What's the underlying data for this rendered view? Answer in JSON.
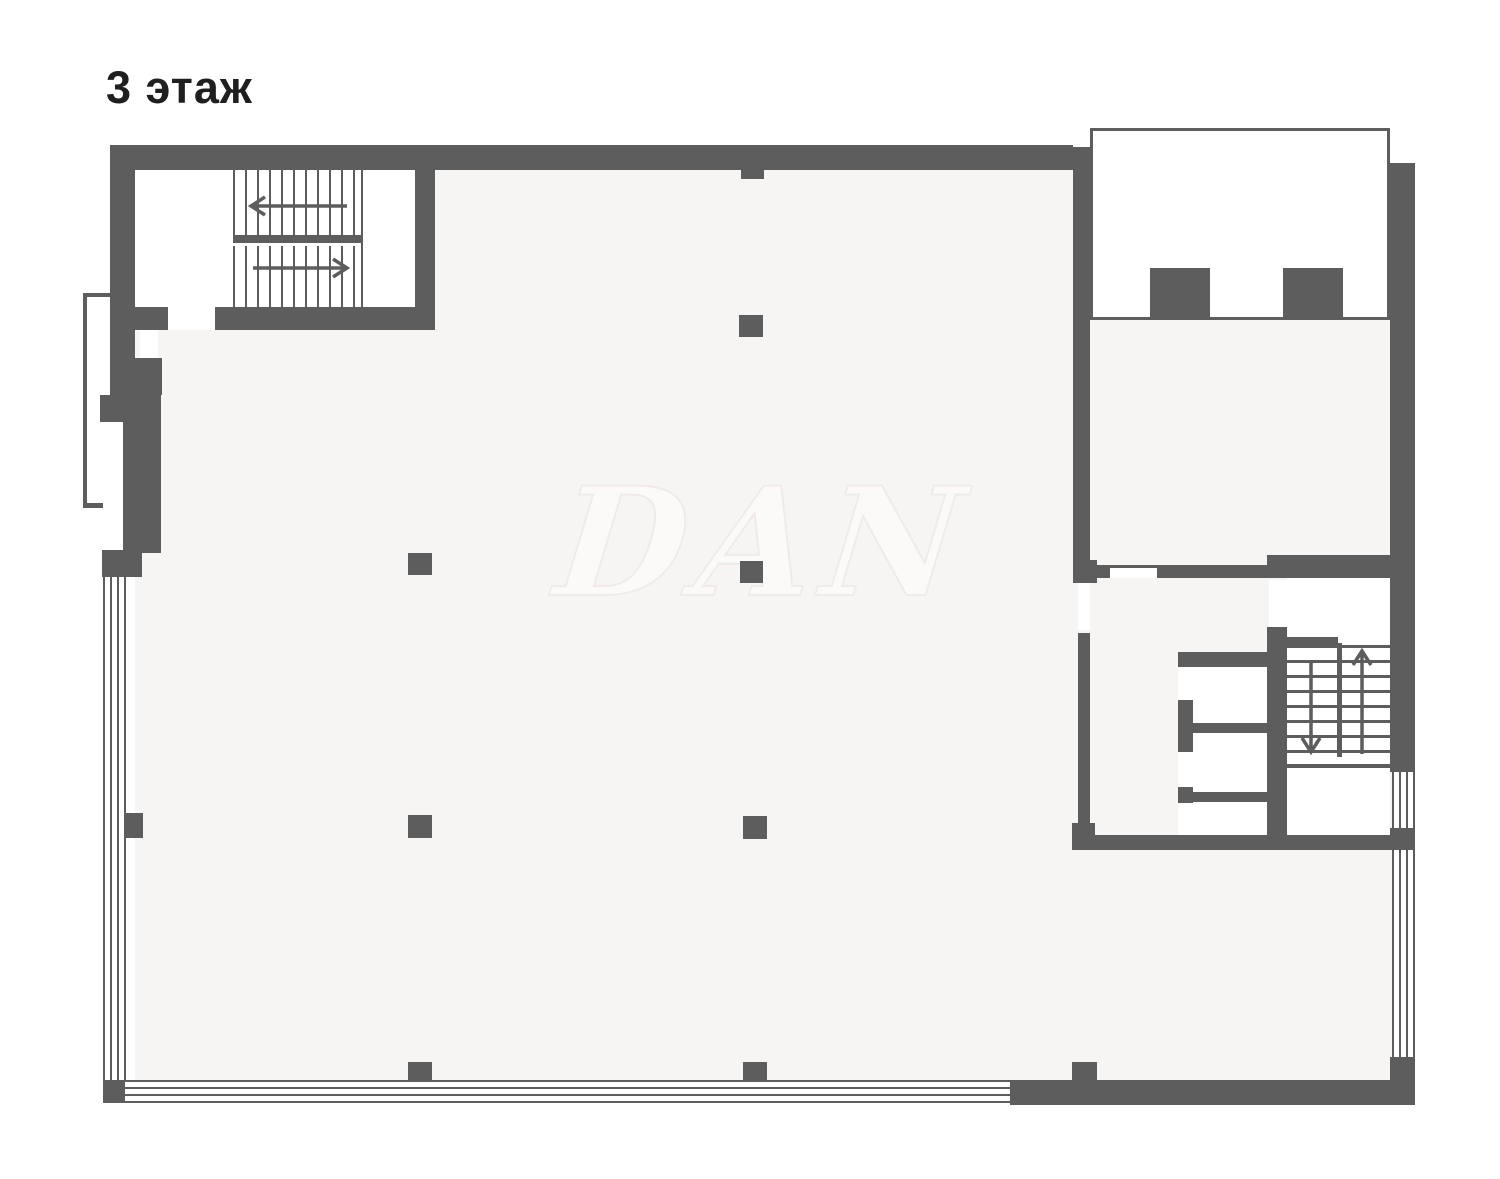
{
  "title": {
    "text": "3 этаж"
  },
  "watermark": {
    "text": "DAN"
  },
  "colors": {
    "wall": "#5d5d5d",
    "floor": "#f7f5f4",
    "background": "#ffffff",
    "title": "#1f1f1f",
    "watermark_fill": "#fbfaf9",
    "watermark_line": "#f2eae7"
  },
  "plan": {
    "floor_rects": [
      [
        135,
        170,
        938,
        910
      ],
      [
        1090,
        320,
        302,
        263
      ],
      [
        1073,
        583,
        319,
        497
      ]
    ],
    "white_rects": [
      [
        135,
        170,
        280,
        137
      ],
      [
        168,
        307,
        47,
        23
      ],
      [
        1110,
        568,
        47,
        10
      ],
      [
        1269,
        580,
        18,
        47
      ],
      [
        1193,
        667,
        74,
        168
      ],
      [
        1178,
        667,
        15,
        33
      ],
      [
        1178,
        752,
        15,
        35
      ],
      [
        1178,
        803,
        15,
        32
      ],
      [
        1287,
        578,
        103,
        186
      ],
      [
        1287,
        768,
        103,
        67
      ],
      [
        140,
        330,
        18,
        28
      ],
      [
        1078,
        583,
        12,
        47
      ]
    ],
    "walls": [
      [
        110,
        145,
        963,
        25
      ],
      [
        1073,
        147,
        17,
        413
      ],
      [
        1073,
        560,
        24,
        23
      ],
      [
        1390,
        163,
        25,
        609
      ],
      [
        1390,
        828,
        25,
        22
      ],
      [
        1390,
        1057,
        25,
        48
      ],
      [
        1010,
        1080,
        403,
        25
      ],
      [
        103,
        1080,
        22,
        23
      ],
      [
        110,
        145,
        25,
        250
      ],
      [
        100,
        395,
        61,
        27
      ],
      [
        123,
        422,
        38,
        131
      ],
      [
        102,
        550,
        40,
        27
      ],
      [
        135,
        358,
        27,
        37
      ],
      [
        126,
        813,
        17,
        25
      ],
      [
        110,
        307,
        58,
        23
      ],
      [
        215,
        307,
        220,
        23
      ],
      [
        415,
        170,
        20,
        137
      ],
      [
        233,
        235,
        130,
        8
      ],
      [
        361,
        170,
        2,
        137
      ],
      [
        739,
        315,
        24,
        22
      ],
      [
        408,
        553,
        24,
        22
      ],
      [
        740,
        561,
        23,
        22
      ],
      [
        408,
        815,
        24,
        23
      ],
      [
        743,
        816,
        24,
        23
      ],
      [
        408,
        1062,
        24,
        18
      ],
      [
        743,
        1062,
        24,
        18
      ],
      [
        1072,
        1062,
        25,
        18
      ],
      [
        741,
        170,
        23,
        9
      ],
      [
        1097,
        565,
        13,
        13
      ],
      [
        1110,
        565,
        47,
        3
      ],
      [
        1157,
        565,
        110,
        13
      ],
      [
        1267,
        555,
        126,
        23
      ],
      [
        1267,
        627,
        20,
        208
      ],
      [
        1178,
        652,
        109,
        15
      ],
      [
        1178,
        700,
        15,
        52
      ],
      [
        1178,
        787,
        15,
        16
      ],
      [
        1193,
        723,
        74,
        10
      ],
      [
        1178,
        792,
        89,
        10
      ],
      [
        1072,
        835,
        318,
        15
      ],
      [
        1078,
        633,
        12,
        202
      ],
      [
        1072,
        823,
        23,
        20
      ],
      [
        1337,
        643,
        5,
        114
      ],
      [
        1287,
        764,
        103,
        4
      ],
      [
        1287,
        637,
        51,
        8
      ],
      [
        83,
        293,
        27,
        4
      ],
      [
        83,
        293,
        4,
        215
      ],
      [
        83,
        503,
        20,
        5
      ],
      [
        1150,
        268,
        60,
        49
      ],
      [
        1283,
        268,
        60,
        49
      ]
    ],
    "outlined_rooms": [
      [
        1090,
        128,
        300,
        192
      ]
    ],
    "windows_h": [
      [
        160,
        148,
        73,
        19
      ],
      [
        467,
        148,
        73,
        19
      ],
      [
        632,
        148,
        73,
        19
      ],
      [
        804,
        148,
        73,
        19
      ],
      [
        969,
        148,
        71,
        19
      ],
      [
        1163,
        1083,
        177,
        19
      ]
    ],
    "glazing_h": [
      [
        103,
        1080,
        907,
        23
      ]
    ],
    "glazing_v": [
      [
        103,
        577,
        23,
        503
      ],
      [
        1392,
        772,
        23,
        56
      ],
      [
        1392,
        848,
        23,
        209
      ]
    ],
    "treads_v": [
      [
        233,
        170,
        130,
        65
      ],
      [
        233,
        246,
        130,
        61
      ]
    ],
    "treads_h": [
      [
        1287,
        645,
        50,
        112
      ],
      [
        1342,
        645,
        48,
        112
      ]
    ],
    "arrows": [
      {
        "x1": 347,
        "y1": 206,
        "x2": 251,
        "y2": 206
      },
      {
        "x1": 253,
        "y1": 268,
        "x2": 347,
        "y2": 268
      },
      {
        "x1": 1311,
        "y1": 660,
        "x2": 1311,
        "y2": 752
      },
      {
        "x1": 1362,
        "y1": 754,
        "x2": 1362,
        "y2": 651
      }
    ]
  }
}
